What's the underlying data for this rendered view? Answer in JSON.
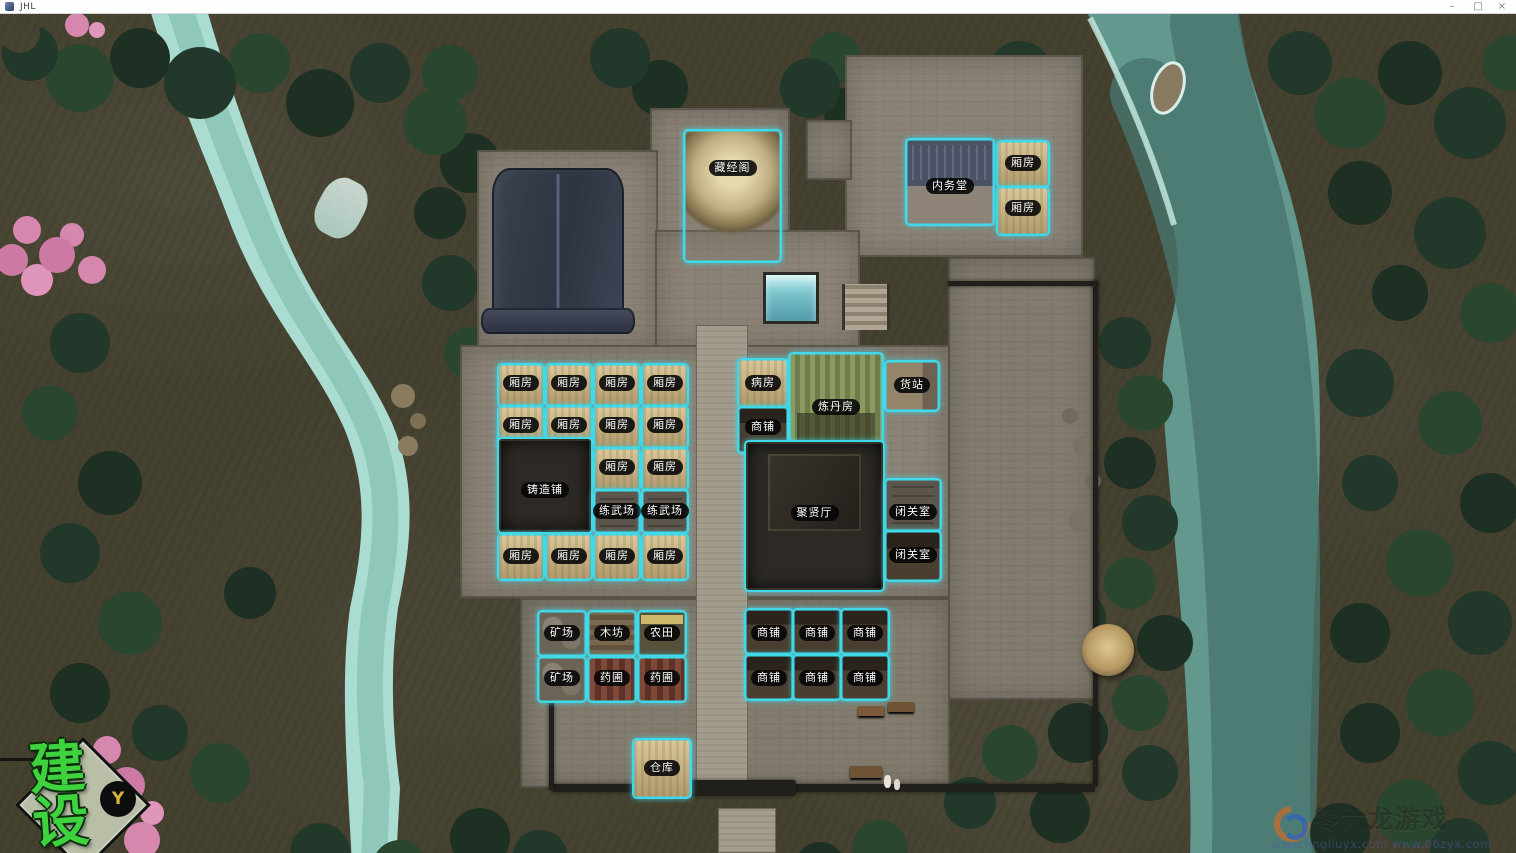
{
  "window": {
    "title": "JHL",
    "minimize_glyph": "–",
    "maximize_glyph": "□",
    "close_glyph": "×"
  },
  "hud": {
    "build_label": "建设",
    "build_key": "Y"
  },
  "watermark": {
    "brand": "零六龙游戏",
    "urls": "www.lingliuyx.com  www.06zyx.com"
  },
  "colors": {
    "plot_outline": "#3fd9ea",
    "label_bg": "#0a0a0a",
    "label_text": "#ffffff",
    "build_green": "#3fd23f",
    "key_gold": "#d8b43a",
    "river": "#62988e",
    "terrain": "#45412f"
  },
  "map": {
    "buildings": [
      {
        "label": "藏经阁",
        "kind": "pavilion",
        "x": 683,
        "y": 129,
        "w": 95,
        "h": 130,
        "ly": 168
      },
      {
        "label": "内务堂",
        "kind": "hall-blue",
        "x": 905,
        "y": 138,
        "w": 86,
        "h": 84,
        "ly": 186
      },
      {
        "label": "厢房",
        "kind": "room",
        "x": 996,
        "y": 140,
        "w": 50,
        "h": 44,
        "ly": 163
      },
      {
        "label": "厢房",
        "kind": "room",
        "x": 996,
        "y": 186,
        "w": 50,
        "h": 46,
        "ly": 208
      },
      {
        "label": "厢房",
        "kind": "room",
        "x": 497,
        "y": 363,
        "w": 44,
        "h": 40,
        "ly": 383
      },
      {
        "label": "厢房",
        "kind": "room",
        "x": 545,
        "y": 363,
        "w": 44,
        "h": 40,
        "ly": 383
      },
      {
        "label": "厢房",
        "kind": "room",
        "x": 593,
        "y": 363,
        "w": 44,
        "h": 40,
        "ly": 383
      },
      {
        "label": "厢房",
        "kind": "room",
        "x": 641,
        "y": 363,
        "w": 44,
        "h": 40,
        "ly": 383
      },
      {
        "label": "厢房",
        "kind": "room",
        "x": 497,
        "y": 405,
        "w": 44,
        "h": 40,
        "ly": 425
      },
      {
        "label": "厢房",
        "kind": "room",
        "x": 545,
        "y": 405,
        "w": 44,
        "h": 40,
        "ly": 425
      },
      {
        "label": "厢房",
        "kind": "room",
        "x": 593,
        "y": 405,
        "w": 44,
        "h": 40,
        "ly": 425
      },
      {
        "label": "厢房",
        "kind": "room",
        "x": 641,
        "y": 405,
        "w": 44,
        "h": 40,
        "ly": 425
      },
      {
        "label": "厢房",
        "kind": "room",
        "x": 593,
        "y": 447,
        "w": 44,
        "h": 40,
        "ly": 467
      },
      {
        "label": "厢房",
        "kind": "room",
        "x": 641,
        "y": 447,
        "w": 44,
        "h": 40,
        "ly": 467
      },
      {
        "label": "铸造铺",
        "kind": "forge",
        "x": 497,
        "y": 437,
        "w": 92,
        "h": 93,
        "ly": 490
      },
      {
        "label": "练武场",
        "kind": "ground",
        "x": 593,
        "y": 489,
        "w": 44,
        "h": 41,
        "ly": 511
      },
      {
        "label": "练武场",
        "kind": "ground",
        "x": 641,
        "y": 489,
        "w": 44,
        "h": 41,
        "ly": 511
      },
      {
        "label": "厢房",
        "kind": "room",
        "x": 497,
        "y": 533,
        "w": 44,
        "h": 44,
        "ly": 556
      },
      {
        "label": "厢房",
        "kind": "room",
        "x": 545,
        "y": 533,
        "w": 44,
        "h": 44,
        "ly": 556
      },
      {
        "label": "厢房",
        "kind": "room",
        "x": 593,
        "y": 533,
        "w": 44,
        "h": 44,
        "ly": 556
      },
      {
        "label": "厢房",
        "kind": "room",
        "x": 641,
        "y": 533,
        "w": 44,
        "h": 44,
        "ly": 556
      },
      {
        "label": "病房",
        "kind": "room",
        "x": 737,
        "y": 358,
        "w": 48,
        "h": 46,
        "ly": 383
      },
      {
        "label": "炼丹房",
        "kind": "alchemy",
        "x": 788,
        "y": 352,
        "w": 92,
        "h": 98,
        "ly": 407
      },
      {
        "label": "货站",
        "kind": "depot",
        "x": 884,
        "y": 360,
        "w": 52,
        "h": 48,
        "ly": 385
      },
      {
        "label": "商铺",
        "kind": "shop",
        "x": 737,
        "y": 406,
        "w": 48,
        "h": 44,
        "ly": 427
      },
      {
        "label": "聚贤厅",
        "kind": "great-hall",
        "x": 744,
        "y": 440,
        "w": 137,
        "h": 148,
        "ly": 513
      },
      {
        "label": "闭关室",
        "kind": "ground",
        "x": 884,
        "y": 478,
        "w": 54,
        "h": 50,
        "ly": 512
      },
      {
        "label": "闭关室",
        "kind": "shop",
        "x": 884,
        "y": 530,
        "w": 54,
        "h": 48,
        "ly": 555
      },
      {
        "label": "矿场",
        "kind": "mine",
        "x": 537,
        "y": 610,
        "w": 46,
        "h": 43,
        "ly": 633
      },
      {
        "label": "木坊",
        "kind": "wood",
        "x": 587,
        "y": 610,
        "w": 46,
        "h": 43,
        "ly": 633
      },
      {
        "label": "农田",
        "kind": "farm",
        "x": 637,
        "y": 610,
        "w": 46,
        "h": 43,
        "ly": 633
      },
      {
        "label": "矿场",
        "kind": "mine",
        "x": 537,
        "y": 656,
        "w": 46,
        "h": 43,
        "ly": 678
      },
      {
        "label": "药圃",
        "kind": "herb",
        "x": 587,
        "y": 656,
        "w": 46,
        "h": 43,
        "ly": 678
      },
      {
        "label": "药圃",
        "kind": "herb",
        "x": 637,
        "y": 656,
        "w": 46,
        "h": 43,
        "ly": 678
      },
      {
        "label": "商铺",
        "kind": "shop",
        "x": 744,
        "y": 608,
        "w": 46,
        "h": 43,
        "ly": 633
      },
      {
        "label": "商铺",
        "kind": "shop",
        "x": 792,
        "y": 608,
        "w": 46,
        "h": 43,
        "ly": 633
      },
      {
        "label": "商铺",
        "kind": "shop",
        "x": 840,
        "y": 608,
        "w": 46,
        "h": 43,
        "ly": 633
      },
      {
        "label": "商铺",
        "kind": "shop",
        "x": 744,
        "y": 654,
        "w": 46,
        "h": 43,
        "ly": 678
      },
      {
        "label": "商铺",
        "kind": "shop",
        "x": 792,
        "y": 654,
        "w": 46,
        "h": 43,
        "ly": 678
      },
      {
        "label": "商铺",
        "kind": "shop",
        "x": 840,
        "y": 654,
        "w": 46,
        "h": 43,
        "ly": 678
      },
      {
        "label": "仓库",
        "kind": "room",
        "x": 632,
        "y": 738,
        "w": 56,
        "h": 57,
        "ly": 768
      }
    ]
  }
}
